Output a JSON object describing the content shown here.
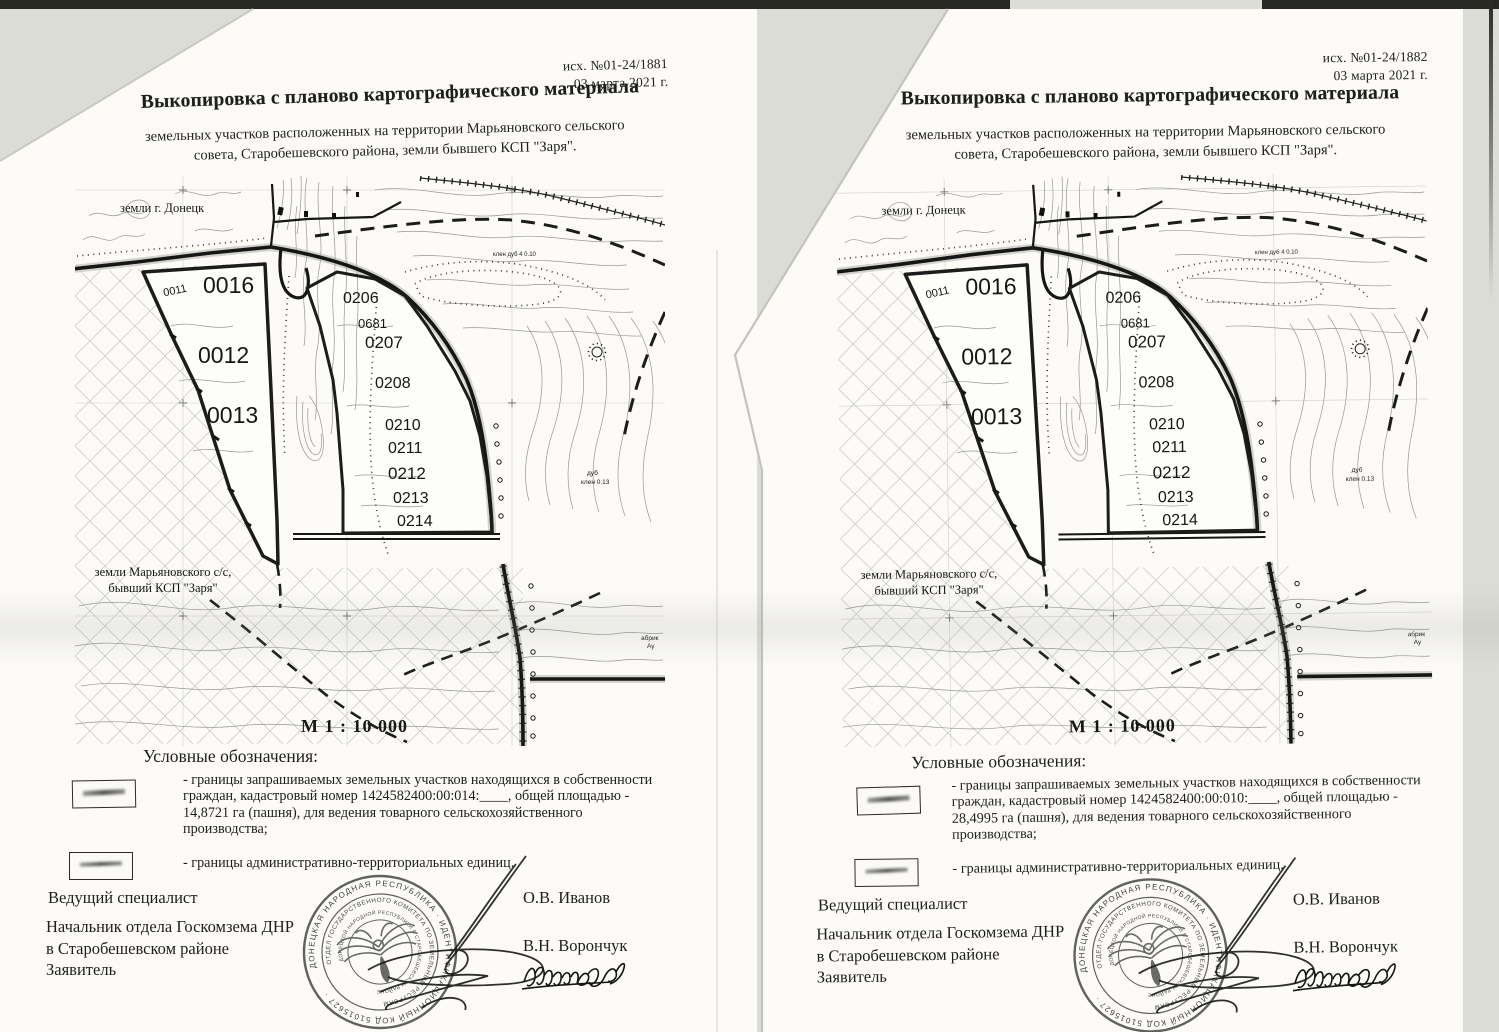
{
  "colors": {
    "paper": "#fcfbf7",
    "ink": "#1e1e1e",
    "scanner_edge": "#272725",
    "background": "#dcdcd7"
  },
  "map": {
    "land_top": "земли г. Донецк",
    "land_bottom": [
      "земли Марьяновского с/с,",
      "бывший КСП \"Заря\""
    ],
    "scale": "М 1 : 10 000",
    "parcels": {
      "p0011": "0011",
      "p0016": "0016",
      "p0012": "0012",
      "p0013": "0013",
      "p0206": "0206",
      "p0681": "0681",
      "p0207": "0207",
      "p0208": "0208",
      "p0210": "0210",
      "p0211": "0211",
      "p0212": "0212",
      "p0213": "0213",
      "p0214": "0214"
    },
    "notes": {
      "trees_top": "клен дуб 4 0.10",
      "tree1": "дуб",
      "tree2": "клен 0.13",
      "edge1": "абрик",
      "edge2": "Ау"
    }
  },
  "stamp": {
    "ring_outer": "ДОНЕЦКАЯ НАРОДНАЯ РЕСПУБЛИКА · ИДЕНТИФИКАЦИОННЫЙ КОД 51015627 ·",
    "ring_middle": "ОТДЕЛ ГОСУДАРСТВЕННОГО КОМИТЕТА ПО ЗЕМЕЛЬНЫМ РЕСУРСАМ",
    "ring_inner": "ДОНЕЦКОЙ НАРОДНОЙ РЕСПУБЛИКИ В СТАРОБЕШЕВСКОМ РАЙОНЕ"
  },
  "documents": [
    {
      "ref_number": "исх. №01-24/1881",
      "date": "03 марта 2021 г.",
      "title": "Выкопировка с планово картографического материала",
      "subtitle": [
        "земельных участков расположенных на территории Марьяновского сельского",
        "совета, Старобешевского района, земли бывшего КСП \"Заря\"."
      ],
      "legend_title": "Условные обозначения:",
      "legend1": [
        "- границы запрашиваемых земельных участков находящихся в собственности",
        "граждан, кадастровый номер 1424582400:00:014:____, общей площадью -",
        "14,8721 га (пашня), для ведения товарного сельскохозяйственного",
        "производства;"
      ],
      "legend2": "- границы административно-территориальных единиц.",
      "footer": {
        "role1": "Ведущий специалист",
        "name1": "О.В. Иванов",
        "role2": [
          "Начальник отдела Госкомзема ДНР",
          "в Старобешевском районе"
        ],
        "name2": "В.Н. Ворончук",
        "role3": "Заявитель"
      }
    },
    {
      "ref_number": "исх. №01-24/1882",
      "date": "03 марта 2021 г.",
      "title": "Выкопировка с планово картографического материала",
      "subtitle": [
        "земельных участков расположенных на территории Марьяновского сельского",
        "совета, Старобешевского района, земли бывшего КСП \"Заря\"."
      ],
      "legend_title": "Условные обозначения:",
      "legend1": [
        "- границы запрашиваемых земельных участков находящихся в собственности",
        "граждан, кадастровый номер 1424582400:00:010:____, общей площадью -",
        "28,4995 га (пашня), для ведения товарного сельскохозяйственного",
        "производства;"
      ],
      "legend2": "- границы административно-территориальных единиц.",
      "footer": {
        "role1": "Ведущий специалист",
        "name1": "О.В. Иванов",
        "role2": [
          "Начальник отдела Госкомзема ДНР",
          "в Старобешевском районе"
        ],
        "name2": "В.Н. Ворончук",
        "role3": "Заявитель"
      }
    }
  ]
}
